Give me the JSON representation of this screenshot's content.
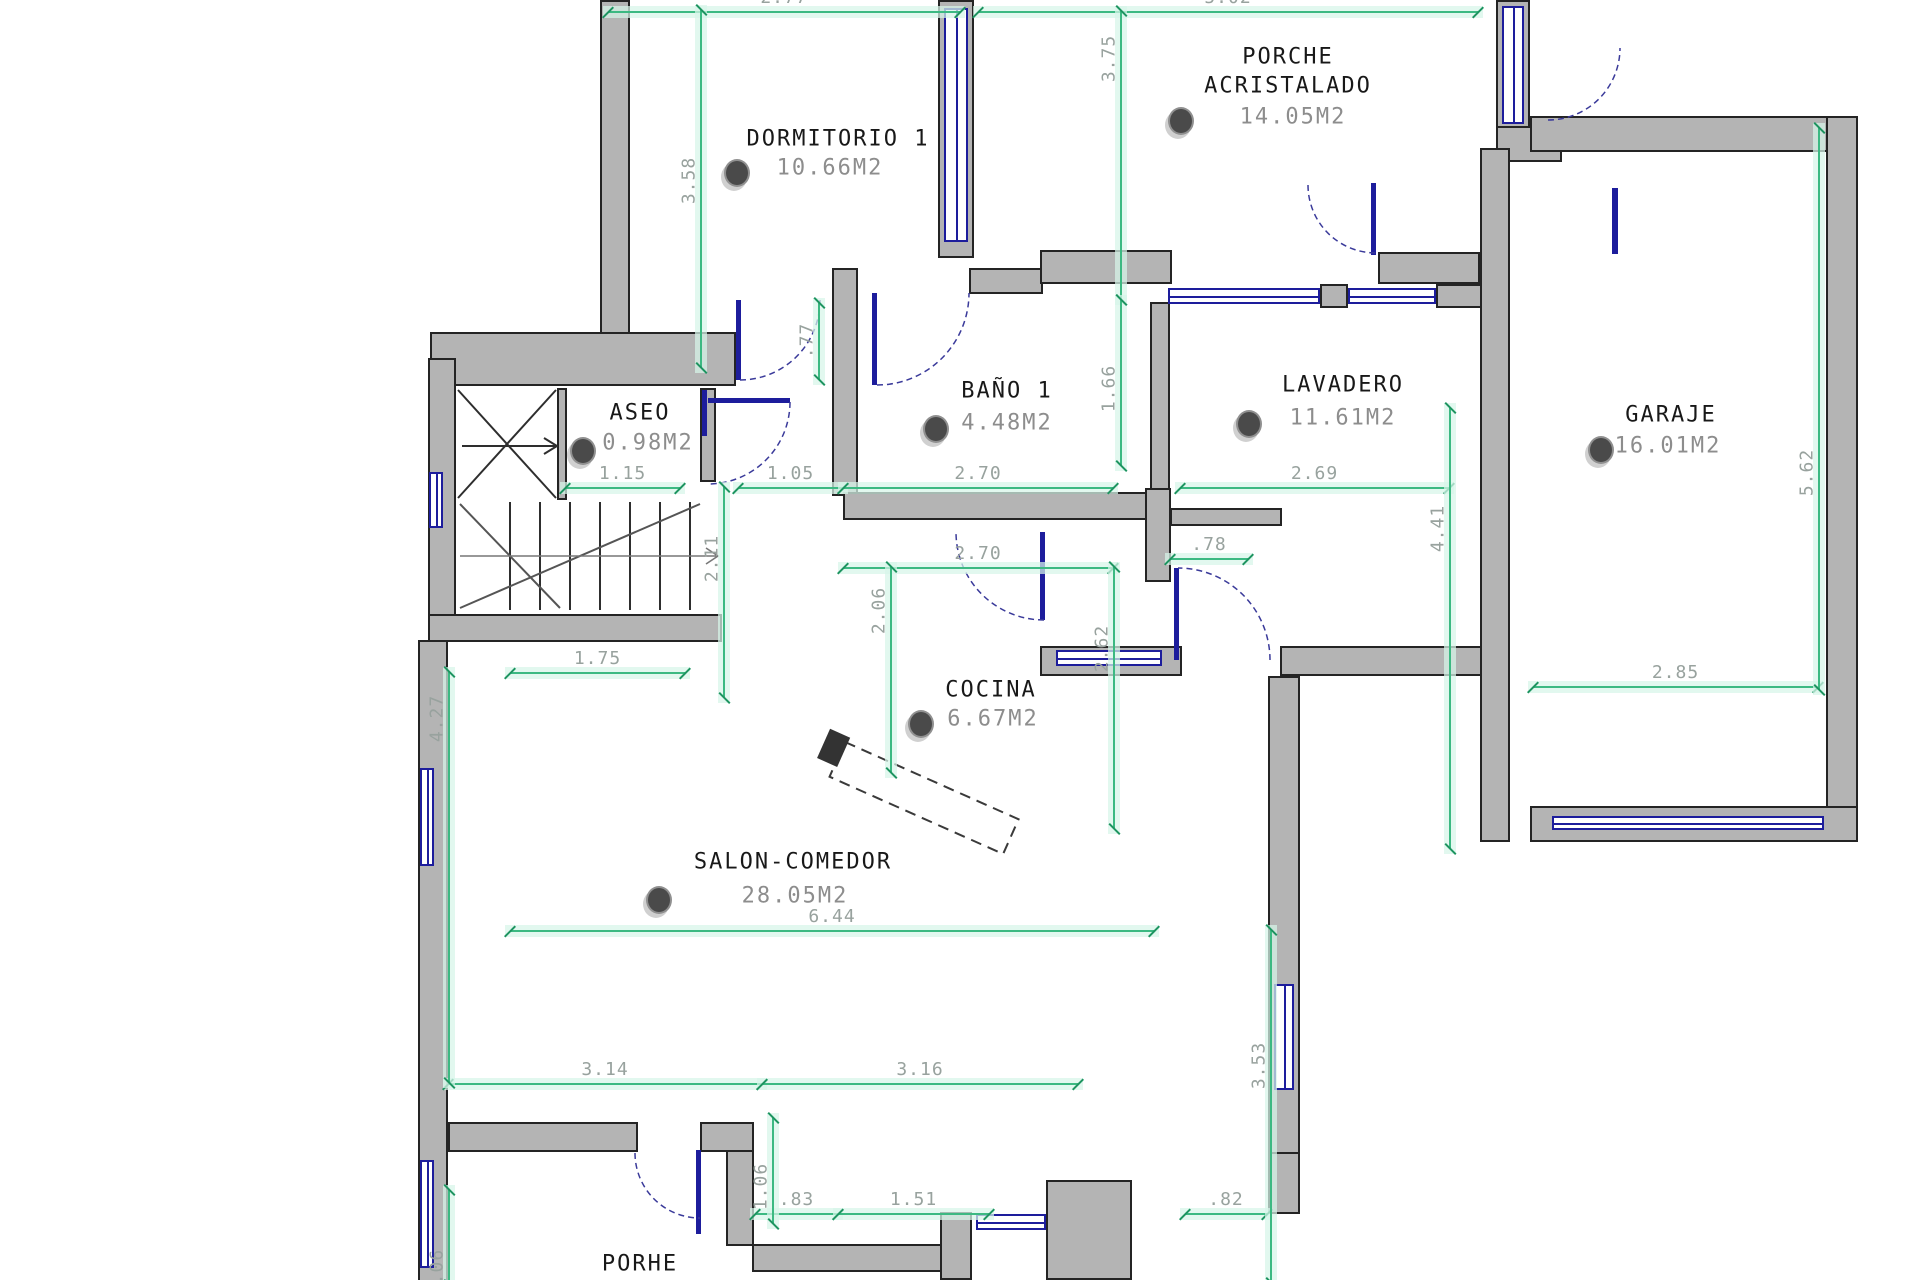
{
  "drawing_type": "floor plan (plano acotado)",
  "rooms": [
    {
      "name": "DORMITORIO 1",
      "area": "10.66M2"
    },
    {
      "name": "PORCHE",
      "name2": "ACRISTALADO",
      "area": "14.05M2"
    },
    {
      "name": "ASEO",
      "area": "0.98M2"
    },
    {
      "name": "BAÑO 1",
      "area": "4.48M2"
    },
    {
      "name": "LAVADERO",
      "area": "11.61M2"
    },
    {
      "name": "GARAJE",
      "area": "16.01M2"
    },
    {
      "name": "COCINA",
      "area": "6.67M2"
    },
    {
      "name": "SALON-COMEDOR",
      "area": "28.05M2"
    },
    {
      "name": "PORHE",
      "area": "5.05M2"
    }
  ],
  "dims": {
    "top_left": "2.77",
    "top_right": "5.02",
    "dorm_h": "3.58",
    "porche_h": "3.75",
    "aseo_w": "1.15",
    "hall_w": "1.05",
    "bano_w": "2.70",
    "lavadero_w": "2.69",
    "cocina_top_w": "2.70",
    "pass_w": ".78",
    "pass_h": "1.66",
    "door_h": ".77",
    "hall_h": "2.11",
    "cocina_h": "2.06",
    "cocina_h2": "2.62",
    "lavadero_h": "4.41",
    "garaje_h": "5.62",
    "garaje_w": "2.85",
    "salon_top_w": "1.75",
    "salon_h": "4.27",
    "salon_w": "6.44",
    "salon_right_h": "3.53",
    "bottom_w1": "3.14",
    "bottom_w2": "3.16",
    "porhe_door_h": "1.06",
    "porhe_w1": ".83",
    "porhe_w2": "1.51",
    "porhe_w3": ".82",
    "bottom_left_h": "1.06"
  },
  "colors": {
    "wall": "#b4b4b4",
    "window": "#1d1d9c",
    "dimension_line": "#3cb982",
    "dimension_text": "#98a29e",
    "room_text": "#181818",
    "area_text": "#8d8d8d"
  }
}
